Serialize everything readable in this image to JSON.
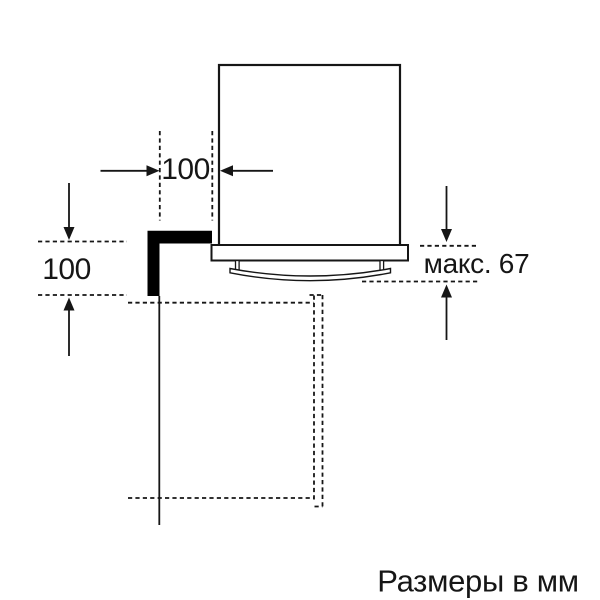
{
  "diagram": {
    "caption": "Размеры в мм",
    "dimensions": [
      {
        "id": "top-side-clearance",
        "label": "100"
      },
      {
        "id": "left-wall-clearance",
        "label": "100"
      },
      {
        "id": "max-handle-depth",
        "label": "макс. 67"
      }
    ],
    "colors": {
      "line": "#161616",
      "background": "#ffffff",
      "wall_fill": "#000000"
    }
  }
}
